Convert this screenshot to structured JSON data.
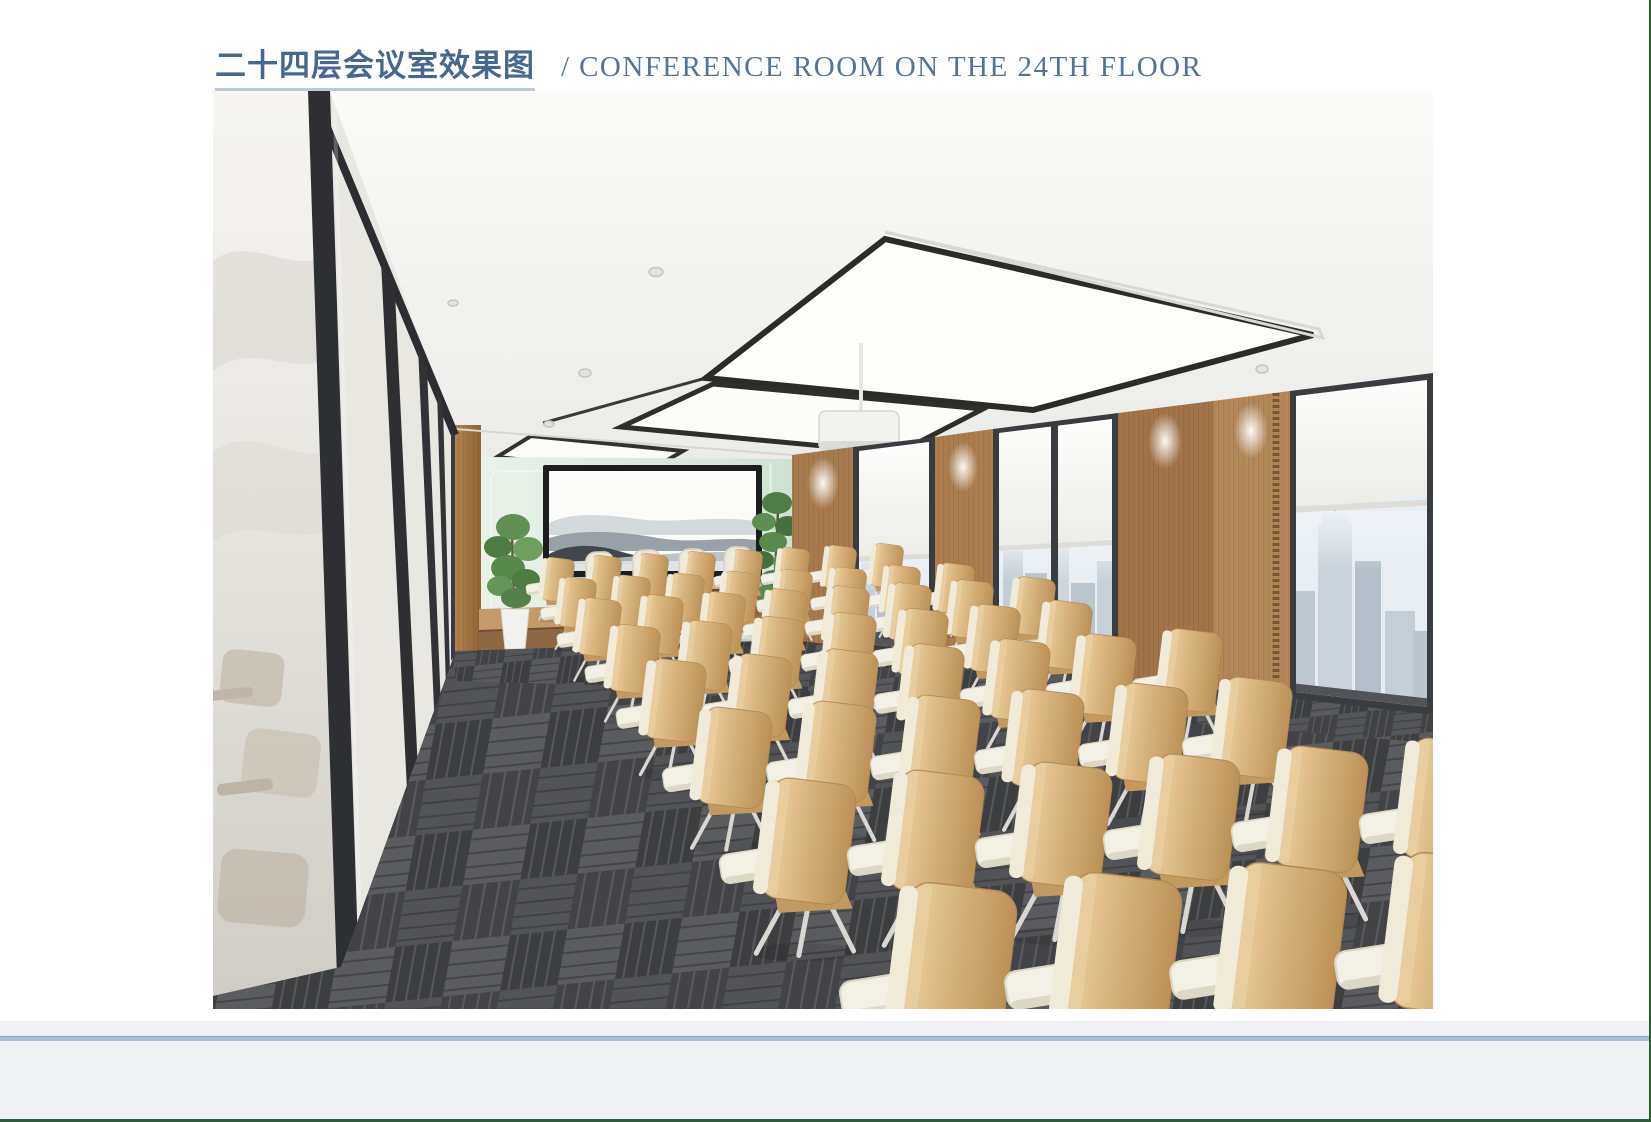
{
  "header": {
    "title_cn": "二十四层会议室效果图",
    "divider": "/",
    "title_en": "CONFERENCE ROOM ON THE 24TH FLOOR"
  },
  "colors": {
    "title_blue": "#46688f",
    "title_underline": "#b9cade",
    "footer_band": "#eff1f4",
    "footer_line": "#abc0d6",
    "page_edge_green": "#2e5a37",
    "chair_tan": "#d8b27c",
    "tablet_cream": "#f3f0e6",
    "carpet_dark": "#4a4b4e",
    "wood_panel": "#ab7d4f",
    "mint_glass": "#dcebdd",
    "mullion_black": "#2d2f32"
  },
  "illustration": {
    "alt": "3D rendering of the 24th floor conference room: rows of tan tablet-arm chairs on dark grey carpet tiles, a wooden head table with four cream chairs beneath a large ink-wash mountain artwork on a mint glass wall, potted plants, a black framed glass partition on the left, wood panels and floor-to-ceiling windows with white roller shades and a hazy city skyline on the right, and large luminous ceiling light panels with a projector.",
    "chair_rows": [
      {
        "count": 8,
        "x": 322,
        "y": 468,
        "dx": 47,
        "dy": -2,
        "scale": 0.4
      },
      {
        "count": 8,
        "x": 338,
        "y": 488,
        "dx": 54,
        "dy": -2,
        "scale": 0.46
      },
      {
        "count": 8,
        "x": 356,
        "y": 509,
        "dx": 62,
        "dy": -3,
        "scale": 0.53
      },
      {
        "count": 7,
        "x": 386,
        "y": 536,
        "dx": 72,
        "dy": -4,
        "scale": 0.62
      },
      {
        "count": 7,
        "x": 420,
        "y": 571,
        "dx": 86,
        "dy": -5,
        "scale": 0.74
      },
      {
        "count": 6,
        "x": 470,
        "y": 620,
        "dx": 104,
        "dy": -6,
        "scale": 0.9
      },
      {
        "count": 6,
        "x": 532,
        "y": 692,
        "dx": 128,
        "dy": -8,
        "scale": 1.12
      },
      {
        "count": 4,
        "x": 660,
        "y": 798,
        "dx": 165,
        "dy": -10,
        "scale": 1.45
      }
    ]
  }
}
